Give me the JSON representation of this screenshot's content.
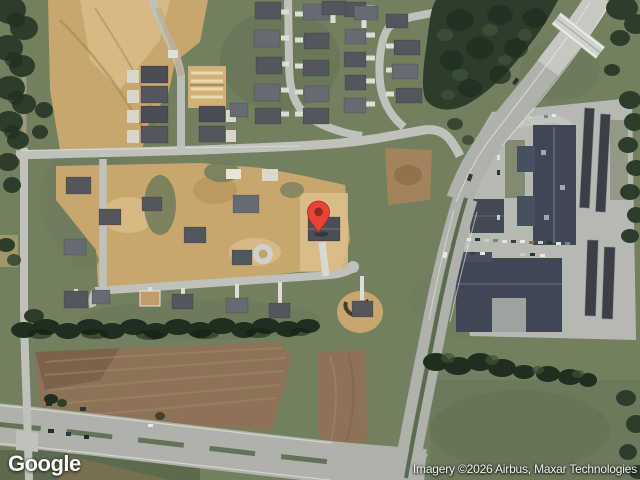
{
  "map": {
    "watermark": "Google",
    "attribution": "Imagery ©2026 Airbus, Maxar Technologies",
    "marker": {
      "x": 318.5,
      "y": 233
    }
  },
  "colors": {
    "grass": "#72805F",
    "grass-dark": "#5C6B4E",
    "tree": "#2C3E2B",
    "tree-dark": "#1F2F1F",
    "dirt": "#C8A76F",
    "dirt-light": "#DCC08D",
    "field": "#8D7257",
    "road": "#BEC2BA",
    "road-concrete": "#CDD0C8",
    "asphalt": "#AEB2AA",
    "roof": "#53575D",
    "roof-light": "#666B71",
    "commercial-roof": "#3F4654",
    "pin-red": "#EA4335",
    "pin-dot": "#8C2B20",
    "watermark-text": "#FFFFFF",
    "attribution-text": "#F2F2F2"
  }
}
